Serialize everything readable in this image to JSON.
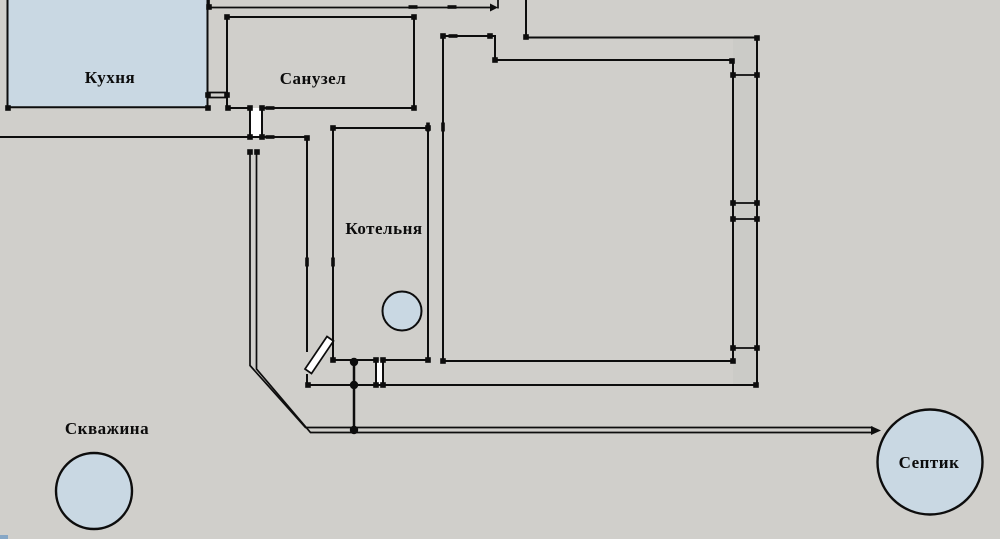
{
  "app": {
    "view": "floor-plan-canvas"
  },
  "labels": {
    "kitchen": "Кухня",
    "bathroom": "Санузел",
    "boiler_room": "Котельня",
    "well": "Скважина",
    "septic": "Септик"
  },
  "colors": {
    "background": "#d0cfcb",
    "line": "#0d0d0d",
    "room_fill": "#c9d8e3",
    "wall_cavity": "#cbcbc7",
    "door_fill": "#ffffff",
    "label_color": "#0c0c0c",
    "bottom_left_accent": "#86a7c6"
  }
}
